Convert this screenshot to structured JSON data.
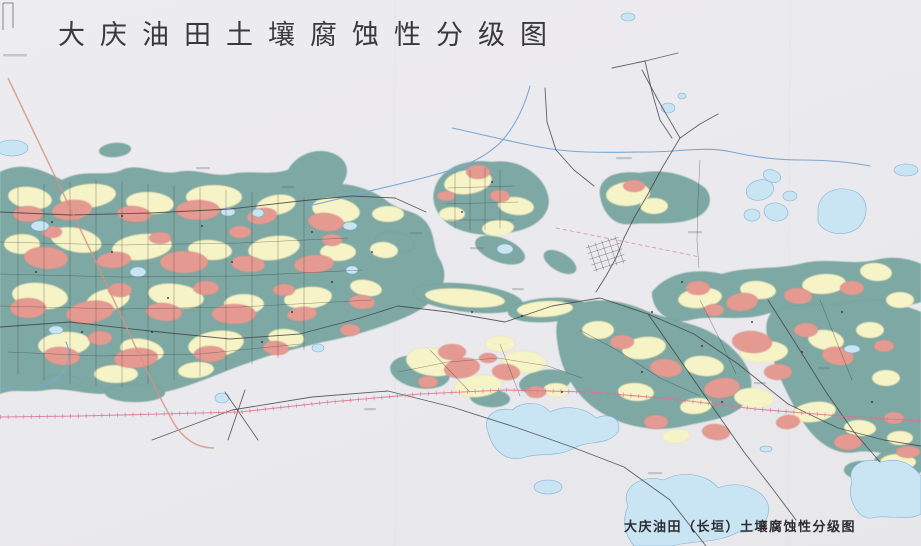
{
  "title": {
    "text": "大庆油田土壤腐蚀性分级图"
  },
  "caption": {
    "text": "大庆油田（长垣）土壤腐蚀性分级图"
  },
  "map": {
    "type": "scanned-thematic-map",
    "subject": "soil corrosivity classification of the Daqing oilfield (Changyuan)",
    "colors": {
      "paper": "#eae9ed",
      "region_strong": "#e49a90",
      "region_medium": "#f6f3c6",
      "region_weak": "#7da8a3",
      "lake": "#c9e4f2",
      "lake_outline": "#7fb2d8",
      "river": "#7aa9d6",
      "road": "#3f3d3c",
      "railway": "#d9768f",
      "highway": "#d98f82"
    }
  }
}
